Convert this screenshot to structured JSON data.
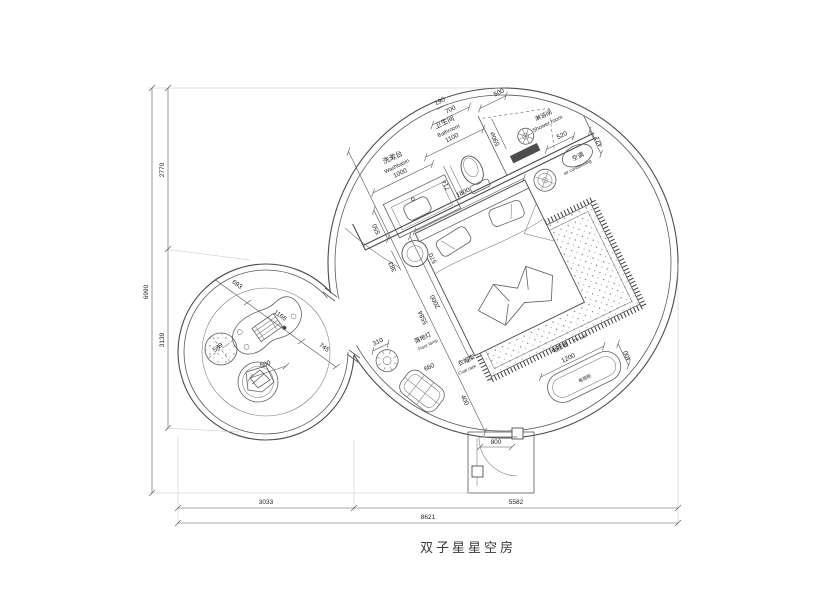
{
  "title": "双子星星空房",
  "dimensions": {
    "overall_width": "8621",
    "width_left": "3033",
    "width_right": "5582",
    "overall_height": "6990",
    "height_upper": "2770",
    "height_lower": "3139"
  },
  "entry": {
    "door_width": "800"
  },
  "room": {
    "diagonal": "5584"
  },
  "bathroom": {
    "label_cn": "卫生间",
    "label_en": "Bathroom",
    "width": "1100",
    "wall_offset": "190",
    "inner_width": "700",
    "toilet_depth": "714"
  },
  "washbasin": {
    "label_cn": "洗漱台",
    "label_en": "Washbasin",
    "width": "1000",
    "depth": "550"
  },
  "shower": {
    "label_cn": "淋浴间",
    "label_en": "Shower room",
    "width": "500",
    "diameter": "590⌀"
  },
  "aircon": {
    "label_cn": "空调",
    "label_en": "air conditioning",
    "width": "520",
    "depth": "421"
  },
  "bed": {
    "width": "1800",
    "length": "2000",
    "side_table_dia": "383",
    "side_table_offset": "570"
  },
  "floor_lamp": {
    "label_cn": "落地灯",
    "label_en": "Floor lamp",
    "width": "310"
  },
  "coat_rack": {
    "label_cn": "衣帽架",
    "label_en": "Coat rack",
    "width": "660",
    "depth": "400"
  },
  "tv_wall": {
    "label_cn": "电视墙",
    "label_en": "TV wall",
    "width": "1200",
    "depth": "400",
    "cabinet_label": "电视柜"
  },
  "lounge": {
    "seg_left": "693",
    "desk_width": "1166",
    "seg_right": "745",
    "pouf_dia": "589",
    "chair_width": "500"
  }
}
